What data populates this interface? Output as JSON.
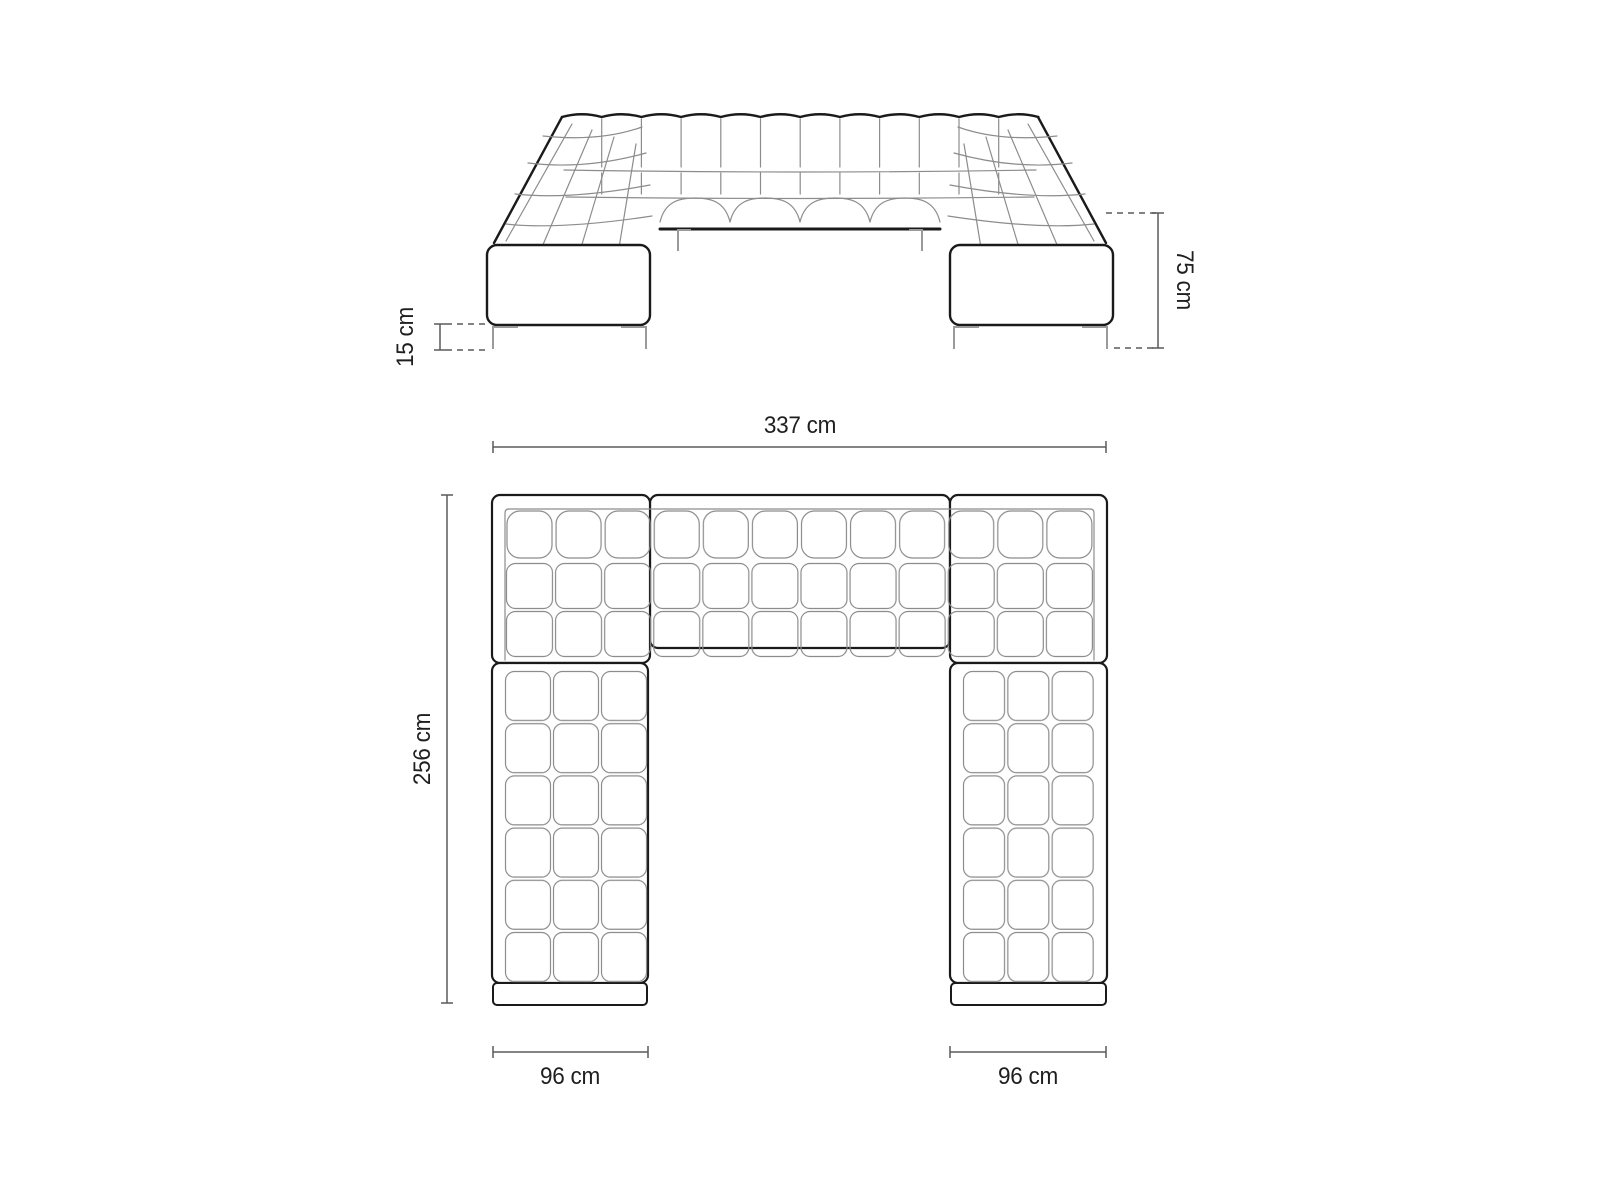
{
  "colors": {
    "outline": "#1a1a1a",
    "tuft_lines": "#8c8c8c",
    "dimension_lines": "#5a5a5a",
    "text": "#1f1f1f",
    "background": "#ffffff"
  },
  "front_view": {
    "leg_height_label": "15 cm",
    "overall_height_label": "75 cm"
  },
  "top_view": {
    "overall_width_label": "337 cm",
    "overall_depth_label": "256 cm",
    "left_arm_width_label": "96 cm",
    "right_arm_width_label": "96 cm"
  }
}
